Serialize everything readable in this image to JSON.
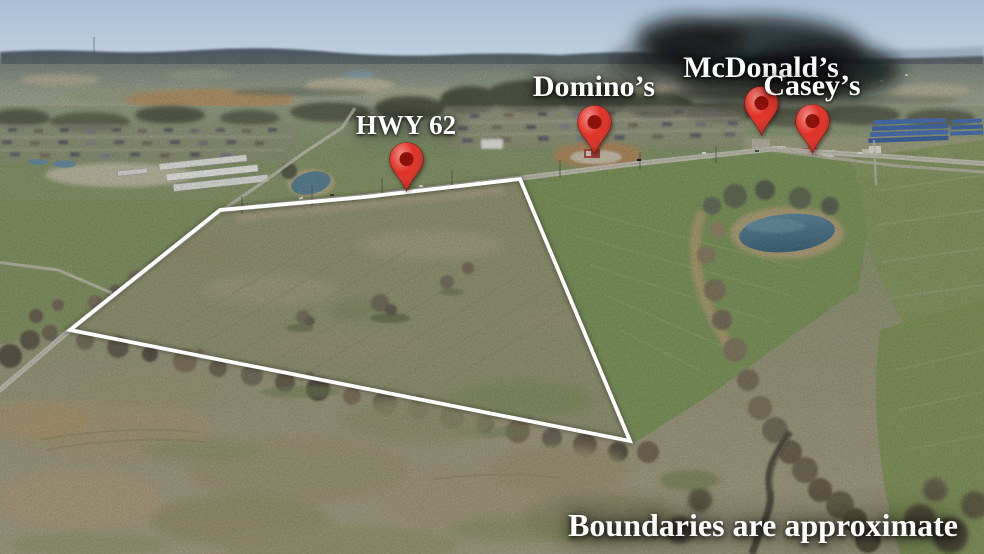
{
  "scene": {
    "alt": "Aerial drone photo of a vacant land parcel outlined in white, with nearby highway and businesses marked by red map pins",
    "disclaimer": "Boundaries are approximate"
  },
  "pins": {
    "hwy62": {
      "label": "HWY 62"
    },
    "dominos": {
      "label": "Domino’s"
    },
    "mcdonalds": {
      "label": "McDonald’s"
    },
    "caseys": {
      "label": "Casey’s"
    }
  },
  "colors": {
    "pin_red": "#e0271b",
    "pin_red_dark": "#8e120c",
    "label_text": "#ffffff",
    "boundary_white": "#ffffff",
    "sky_top": "#a9bed6",
    "sky_horizon": "#d6e0e9",
    "ridge_blue": "#4a5560",
    "field_green": "#73904f",
    "property_olive": "#8b8f6a",
    "foreground_tan": "#9c9276",
    "pond_blue": "#3e708c"
  }
}
